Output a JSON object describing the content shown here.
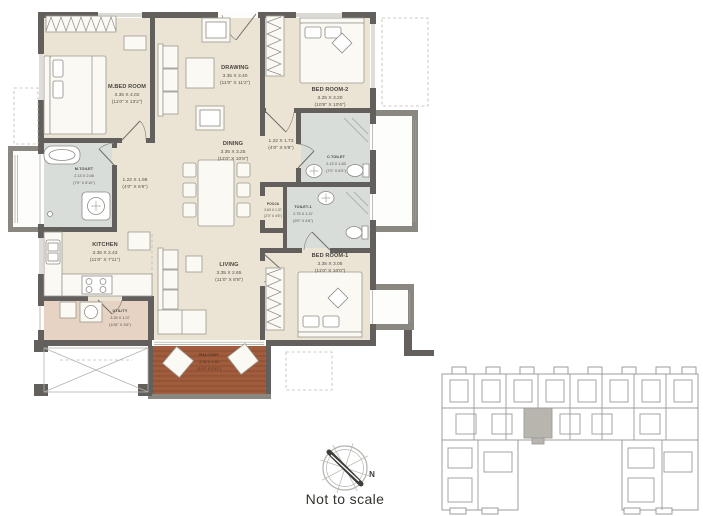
{
  "plan": {
    "rooms": {
      "mbedroom": {
        "name": "M.BED ROOM",
        "metric": "3.35 X 4.02",
        "imperial": "(11'0\" X 13'2\")"
      },
      "drawing": {
        "name": "DRAWING",
        "metric": "3.35 X 3.40",
        "imperial": "(11'0\" X 11'2\")"
      },
      "bedroom2": {
        "name": "BED ROOM-2",
        "metric": "3.25 X 3.20",
        "imperial": "(10'8\" X 10'6\")"
      },
      "mtoilet": {
        "name": "M.TOILET",
        "metric": "2.13 X 2.08",
        "imperial": "(7'0\" X 6'10\")"
      },
      "ctoilet": {
        "name": "C.TOILET",
        "metric": "2.13 X 1.83",
        "imperial": "(7'0\" X 6'0\")"
      },
      "toilet1": {
        "name": "TOILET-1",
        "metric": "2.75 X 1.37",
        "imperial": "(9'0\" X 4'6\")"
      },
      "pooja": {
        "name": "POOJA",
        "metric": "0.63 X 1.37",
        "imperial": "(2'0\" X 4'6\")"
      },
      "dining": {
        "name": "DINING",
        "metric": "3.35 X 3.25",
        "imperial": "(11'0\" X 10'8\")"
      },
      "kitchen": {
        "name": "KITCHEN",
        "metric": "3.35 X 2.43",
        "imperial": "(11'0\" X 7'11\")"
      },
      "utility": {
        "name": "UTILITY",
        "metric": "3.25 X 1.07",
        "imperial": "(10'8\" X 3'6\")"
      },
      "living": {
        "name": "LIVING",
        "metric": "3.35 X 2.65",
        "imperial": "(11'0\" X 8'8\")"
      },
      "bedroom1": {
        "name": "BED ROOM-1",
        "metric": "3.35 X 3.05",
        "imperial": "(11'0\" X 10'0\")"
      },
      "balcony": {
        "name": "BALCONY",
        "metric": "3.35 X 1.80",
        "imperial": "(11'0\" X 5'11\")"
      }
    },
    "passages": {
      "p1": {
        "metric": "1.22 X 1.98",
        "imperial": "(4'0\" X 6'6\")"
      },
      "p2": {
        "metric": "1.22 X 1.73",
        "imperial": "(4'0\" X 5'8\")"
      }
    }
  },
  "compass": {
    "north_label": "N"
  },
  "footer": {
    "scale_note": "Not to scale"
  },
  "colors": {
    "wall": "#625f5c",
    "floor": "#ebe4d4",
    "toilet_floor": "#d9ddd9",
    "utility_floor": "#e7d3c3",
    "balcony_wood": "#a05c3c",
    "keyplan_line": "#9c9c9a",
    "keyplan_highlight": "#b8b5af"
  }
}
